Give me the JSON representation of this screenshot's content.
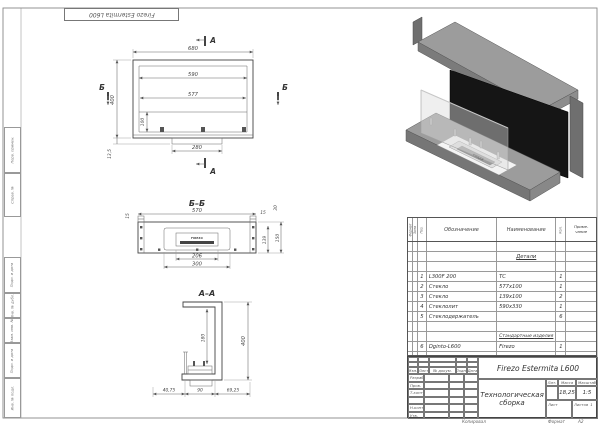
{
  "brand": "FIREZO",
  "margins": {
    "left_labels": [
      "Перв. примен.",
      "Справ. №",
      "Подп. и дата",
      "Инв. № дубл.",
      "Взам. инв. №",
      "Подп. и дата",
      "Инв. № подл."
    ]
  },
  "views": {
    "front": {
      "mark_a": "А",
      "mark_b": "Б",
      "dims": {
        "d680": "680",
        "d590": "590",
        "d577": "577",
        "d400": "400",
        "d100": "100",
        "d280": "280",
        "d135": "13,5"
      }
    },
    "bb": {
      "title": "Б–Б",
      "dims": {
        "d570": "570",
        "d15": "15",
        "d30": "30",
        "d139": "139",
        "d150": "150",
        "d206": "206",
        "d300": "300"
      }
    },
    "aa": {
      "title": "А–А",
      "dims": {
        "d400": "400",
        "d180": "180",
        "d4075": "40,75",
        "d90": "90",
        "d6925": "69,25"
      }
    }
  },
  "spec": {
    "headers": [
      "Формат",
      "Зона",
      "Поз.",
      "Обозначение",
      "Наименование",
      "Кол.",
      "Приме-\nчание"
    ],
    "section_details": "Детали",
    "section_standard": "Стандартные изделия",
    "rows": [
      {
        "pos": "1",
        "des": "L300F 200",
        "name": "ТС",
        "qty": "1"
      },
      {
        "pos": "2",
        "des": "Стекло",
        "name": "577х100",
        "qty": "1"
      },
      {
        "pos": "3",
        "des": "Стекло",
        "name": "139х100",
        "qty": "2"
      },
      {
        "pos": "4",
        "des": "Стеклолит",
        "name": "590х330",
        "qty": "1"
      },
      {
        "pos": "5",
        "des": "Стеклодержатель",
        "name": "",
        "qty": "6"
      },
      {
        "pos": "6",
        "des": "Dginto-L600",
        "name": "Firezo",
        "qty": "1"
      }
    ]
  },
  "title_block": {
    "product": "Firezo Estermita L600",
    "doc_name": "Технологическая сборка",
    "cols": [
      "Изм.",
      "Лист",
      "№ докум.",
      "Подп.",
      "Дата"
    ],
    "sign_rows": [
      "Разраб.",
      "Пров.",
      "Т.контр.",
      "Н.контр.",
      "Утв."
    ],
    "lit": "Лит.",
    "mass": "Масса",
    "scale": "Масштаб",
    "mass_value": "18,25",
    "scale_value": "1:5",
    "sheet": "Лист",
    "sheets": "Листов",
    "sheets_value": "1",
    "copied": "Копировал",
    "format_label": "Формат",
    "format_value": "А2"
  }
}
